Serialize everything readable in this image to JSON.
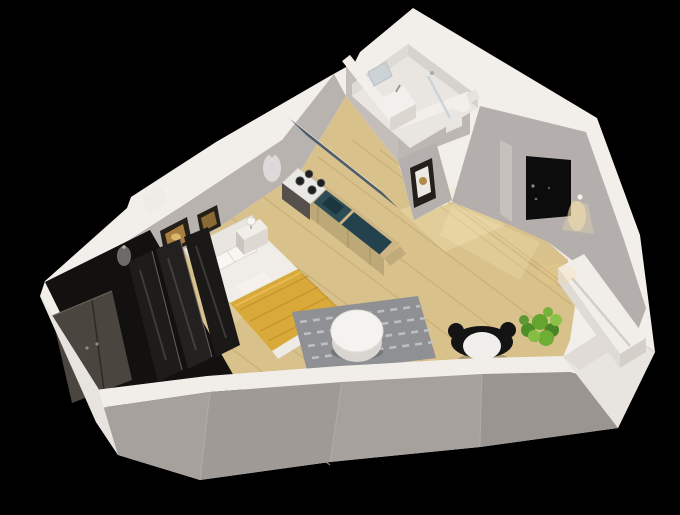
{
  "scene": {
    "description": "3D isometric cutaway render of a studio apartment floor plan on a black background",
    "view": "axonometric cutaway, walls sliced at front",
    "background": "#000000"
  },
  "rooms": {
    "bedroom": "bedroom",
    "kitchen": "kitchenette",
    "bathroom": "bathroom",
    "living": "living area",
    "closet": "wardrobe closet",
    "entry": "entry"
  },
  "objects": {
    "bed": "double bed with yellow blanket",
    "headboard": "white headboard",
    "nightstands": "two white nightstands with lamps",
    "wall_art": "two framed pictures above bed",
    "wardrobe": "dark wardrobe with double doors and glass panels",
    "kitchen_counter": "wood counter with teal sink top",
    "stove": "four burner cooktop",
    "upper_cabinets": "slate upper cabinet row",
    "bath_vanity": "washbasin vanity with mirror",
    "shower": "glass shower",
    "toilet": "toilet",
    "rug": "gray patterned rug",
    "table": "round white coffee table",
    "chair": "black chair with white seat",
    "plant": "green potted plant",
    "sideboard": "white sideboard along right wall",
    "entry_door": "black entry door",
    "wall_lamp": "wall lamp beside entry door"
  },
  "colors": {
    "background": "#000000",
    "wall_top": "#f2efeb",
    "wall_face": "#b9b3b0",
    "wall_face_light": "#c3beba",
    "wall_face_ne": "#b4afac",
    "wall_outer": "#a7a19e",
    "wall_outer_light": "#e8e4e0",
    "floor_wood": "#d8c18b",
    "floor_plank_line": "#c2a870",
    "bath_floor": "#e9e6e2",
    "bath_wall_inner": "#dedad6",
    "blanket_yellow": "#d9a93a",
    "blanket_fold": "#c08d28",
    "bed_white": "#f0ede8",
    "headboard_white": "#e9e5e0",
    "pillow_white": "#f8f6f2",
    "nightstand_white": "#f1eeea",
    "rug_gray": "#8e9094",
    "rug_pattern": "#c6c8cb",
    "closet_dark": "#131110",
    "closet_door": "#4b453f",
    "glass_panel": "#1e1b19",
    "counter_teal": "#2d4c55",
    "counter_teal_dark": "#24424e",
    "cabinet_wood": "#cdb584",
    "cabinet_front": "#bda878",
    "upper_cabinet_slate": "#4f5d6a",
    "stove_white": "#eae8e4",
    "burner_black": "#1f1f1f",
    "oven_dark": "#55504c",
    "door_black": "#0c0c0c",
    "plant_green": "#63a52e",
    "table_white": "#f5f3f0",
    "chair_black": "#141414",
    "sideboard_white": "#f1eee9",
    "frame_dark": "#241f19",
    "art_amber": "#a87f40",
    "lamp_glow": "#ffe8ad",
    "daylight_patch": "#f6e6b8"
  }
}
